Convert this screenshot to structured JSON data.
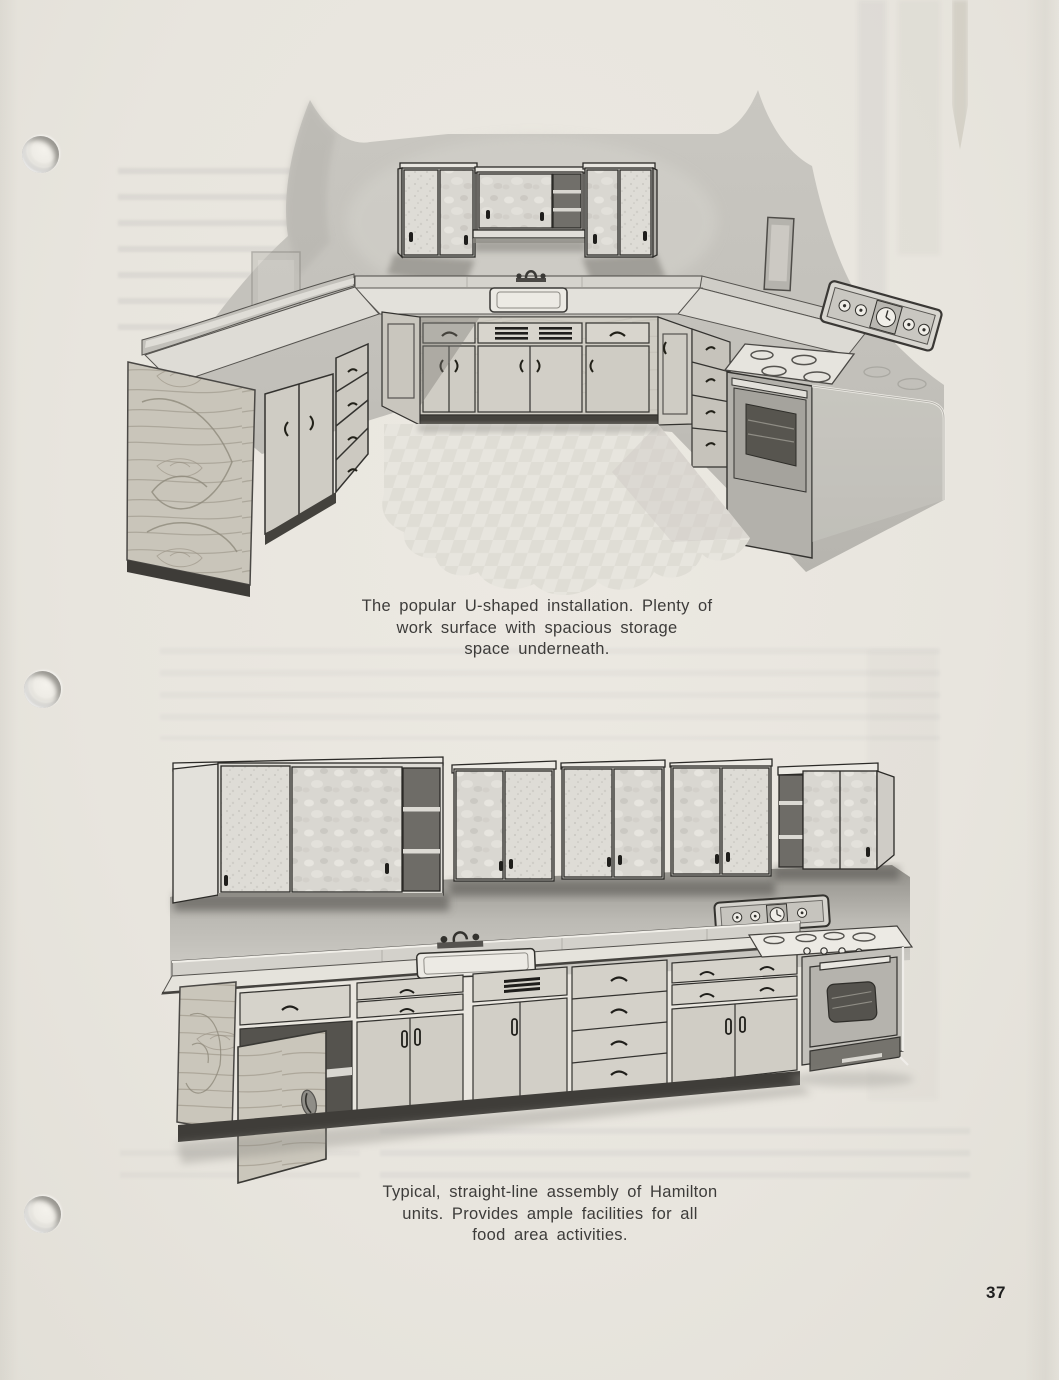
{
  "page": {
    "number": "37",
    "paper_color": "#e8e5de",
    "ink_color": "#3d3c3a"
  },
  "figures": [
    {
      "name": "u-shaped-kitchen-illustration",
      "caption": "The popular U-shaped installation. Plenty of\nwork surface with spacious storage\nspace underneath."
    },
    {
      "name": "straight-line-kitchen-illustration",
      "caption": "Typical, straight-line assembly of Hamilton\nunits. Provides ample facilities for all\nfood area activities."
    }
  ]
}
